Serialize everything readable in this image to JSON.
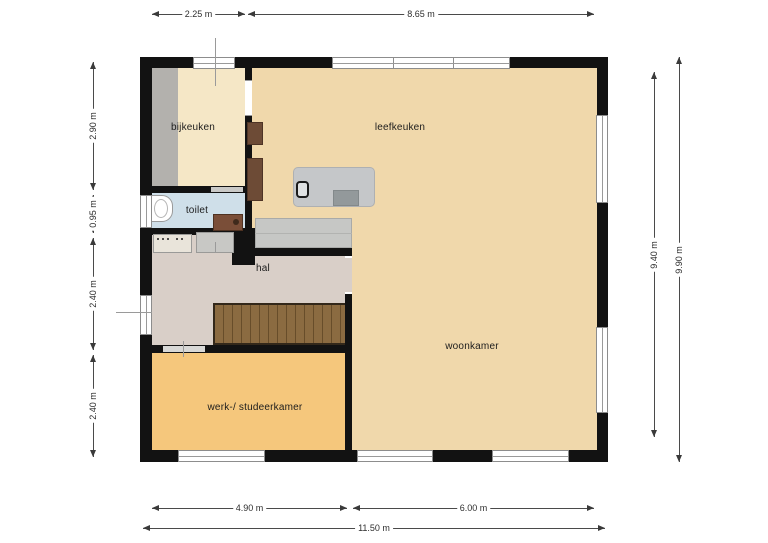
{
  "rooms": {
    "bijkeuken": "bijkeuken",
    "leefkeuken": "leefkeuken",
    "toilet": "toilet",
    "hal": "hal",
    "woonkamer": "woonkamer",
    "werk_studeerkamer": "werk-/ studeerkamer"
  },
  "dimensions": {
    "top": {
      "seg1": "2.25 m",
      "seg2": "8.65 m"
    },
    "left": {
      "seg1": "2.90 m",
      "seg2": "0.95 m",
      "seg3": "2.40 m",
      "seg4": "2.40 m"
    },
    "right": {
      "inner": "9.40 m",
      "outer": "9.90 m"
    },
    "bottom": {
      "seg1": "4.90 m",
      "seg2": "6.00 m",
      "total": "11.50 m"
    }
  },
  "colors": {
    "wall": "#121212",
    "floor_living": "#f0d8ab",
    "floor_bijkeuken": "#f5e7c6",
    "floor_toilet": "#cfdfe9",
    "floor_hal": "#d9cfc8",
    "floor_study": "#f5c77c",
    "stairs": "#8b6b41",
    "cabinets": "#6d4b36",
    "counters": "#c6c7c5"
  }
}
